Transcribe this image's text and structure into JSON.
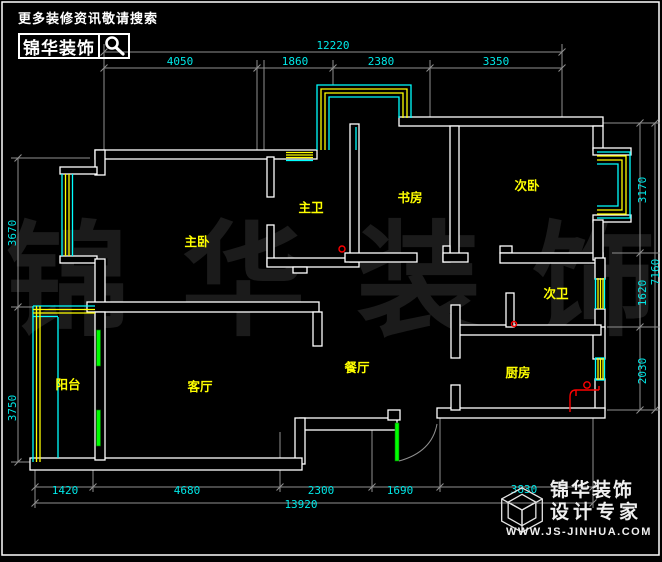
{
  "header": {
    "tagline": "更多装修资讯敬请搜索",
    "brand": "锦华装饰"
  },
  "watermark": {
    "chars": [
      "锦",
      "华",
      "装",
      "饰"
    ]
  },
  "rooms": [
    {
      "label": "主卧"
    },
    {
      "label": "主卫"
    },
    {
      "label": "书房"
    },
    {
      "label": "次卧"
    },
    {
      "label": "次卫"
    },
    {
      "label": "客厅"
    },
    {
      "label": "餐厅"
    },
    {
      "label": "厨房"
    },
    {
      "label": "阳台"
    }
  ],
  "dims": {
    "top": {
      "overall": "12220",
      "segments": [
        "4050",
        "1860",
        "2380",
        "3350"
      ]
    },
    "bottom": {
      "overall": "13920",
      "segments": [
        "1420",
        "4680",
        "2300",
        "1690",
        "3830"
      ]
    },
    "left": {
      "segments": [
        "3670",
        "3750"
      ]
    },
    "right": {
      "overall": "7160",
      "segments": [
        "3170",
        "1620",
        "2030"
      ]
    }
  },
  "footer": {
    "brand": "锦华装饰",
    "subtitle": "设计专家",
    "website": "WWW.JS-JINHUA.COM"
  },
  "colors": {
    "background": "#000000",
    "wall": "#ffffff",
    "dimension": "#00e8e8",
    "room_label": "#ffff00",
    "window_outer": "#00ffff",
    "window_inner": "#ffff00",
    "door": "#00ff00",
    "fixture": "#ff0000",
    "watermark": "#1b1b1b"
  }
}
